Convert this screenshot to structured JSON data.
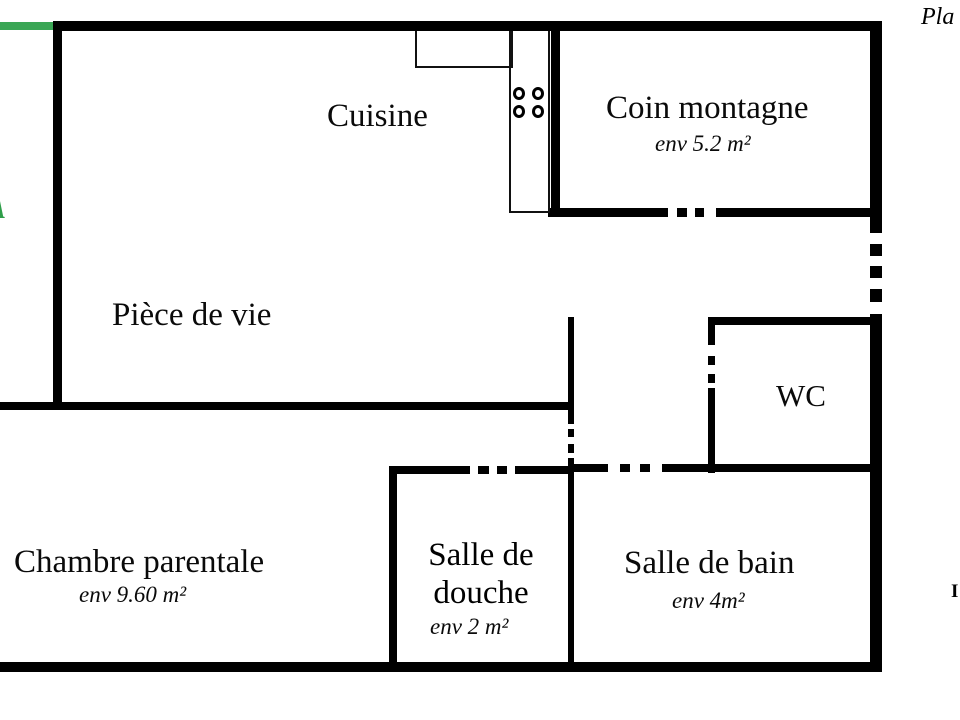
{
  "header": {
    "plan_label": "Pla"
  },
  "rooms": {
    "cuisine": {
      "name": "Cuisine"
    },
    "coin_montagne": {
      "name": "Coin montagne",
      "area": "env 5.2 m²"
    },
    "piece_de_vie": {
      "name": "Pièce de vie"
    },
    "wc": {
      "name": "WC"
    },
    "chambre_parentale": {
      "name": "Chambre parentale",
      "area": "env 9.60 m²"
    },
    "salle_de_douche": {
      "name": "Salle de douche",
      "area": "env 2 m²"
    },
    "salle_de_bain": {
      "name": "Salle de bain",
      "area": "env 4m²"
    }
  },
  "watermark": {
    "color": "#2f9e4a",
    "bar_color": "#3aa655",
    "fragments": [
      {
        "glyph": "r",
        "y": 10
      },
      {
        "glyph": "e",
        "y": 52
      },
      {
        "glyph": "r",
        "y": 88
      },
      {
        "glyph": "s",
        "y": 116
      },
      {
        "glyph": "A",
        "y": 148
      },
      {
        "glyph": "t",
        "y": 190
      },
      {
        "glyph": "i",
        "y": 218
      },
      {
        "glyph": ".",
        "y": 238
      },
      {
        "glyph": "e",
        "y": 292
      }
    ]
  },
  "edge_fragments": {
    "right_letter": "I"
  },
  "colors": {
    "wall": "#000000",
    "background": "#ffffff"
  }
}
